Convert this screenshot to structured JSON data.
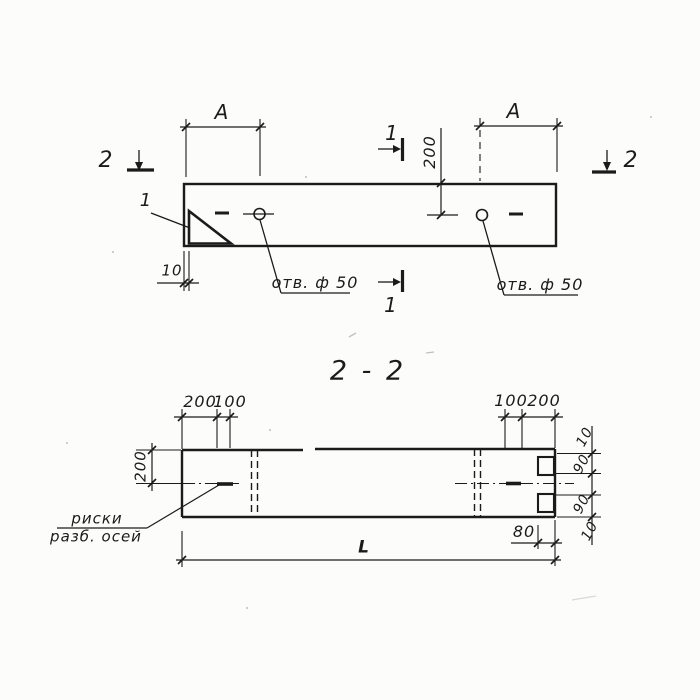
{
  "colors": {
    "ink": "#1b1b1b",
    "paper": "#fcfcfa"
  },
  "top_view": {
    "dim_a_left": "А",
    "dim_a_right": "А",
    "dim_top_offset": "200",
    "dim_plate_thickness": "10",
    "hole_label_left": "отв. ф 50",
    "hole_label_right": "отв. ф 50",
    "detail_mark": "1",
    "section_mark_left": "2",
    "section_mark_right": "2",
    "section_mark_top": "1",
    "section_mark_bottom": "1"
  },
  "section_view": {
    "title": "2 - 2",
    "dims_top_left": [
      "200",
      "100"
    ],
    "dims_top_right": [
      "100",
      "200"
    ],
    "dim_height": "200",
    "dims_right_edge": [
      "10",
      "90",
      "90",
      "10"
    ],
    "dim_notch_depth": "80",
    "dim_total_length": "L",
    "axis_label_line1": "риски",
    "axis_label_line2": "разб. осей"
  }
}
